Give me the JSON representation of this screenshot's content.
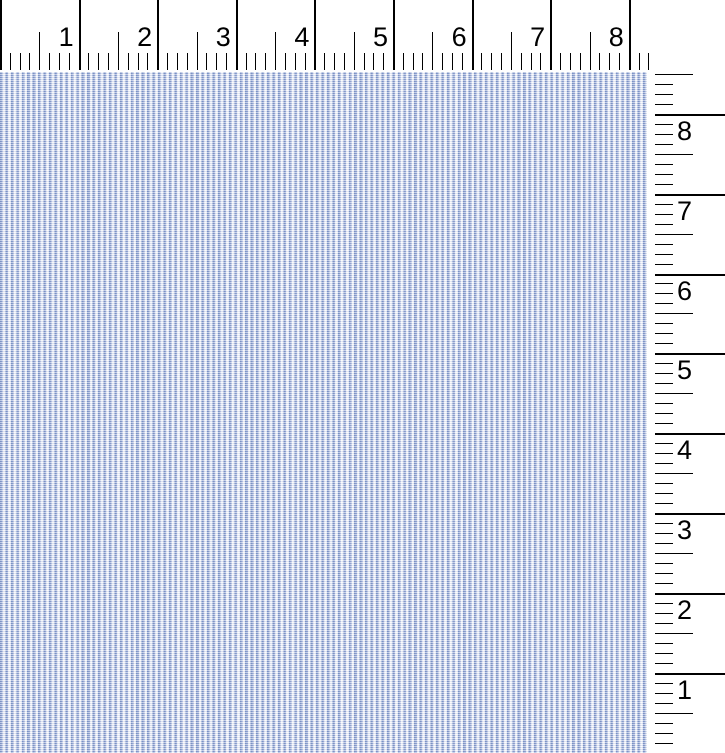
{
  "image": {
    "subject": "Blue and white pinstripe woven fabric swatch shown at scale",
    "background": "#ffffff"
  },
  "top_ruler": {
    "orientation": "horizontal",
    "units": "inches",
    "numbers": [
      "1",
      "2",
      "3",
      "4",
      "5",
      "6",
      "7",
      "8"
    ],
    "minor_ticks_per_inch": 8,
    "pixels_per_inch": 78.6,
    "total_eighths": 66,
    "tick_color": "#000000",
    "number_color": "#000000"
  },
  "right_ruler": {
    "orientation": "vertical",
    "units": "inches",
    "numbers": [
      "8",
      "7",
      "6",
      "5",
      "4",
      "3",
      "2",
      "1"
    ],
    "minor_ticks_per_inch": 8,
    "pixels_per_inch": 79.9,
    "total_eighths": 68,
    "tick_color": "#000000",
    "number_color": "#000000"
  },
  "fabric": {
    "pattern": "fine vertical pinstripe pincord weave",
    "stripe_period_px": 5.45,
    "colors": {
      "stripe_dark": "#7b92c6",
      "stripe_mid": "#94a6d3",
      "stripe_light": "#dde3f3",
      "ground_white": "#f9fafd"
    }
  }
}
